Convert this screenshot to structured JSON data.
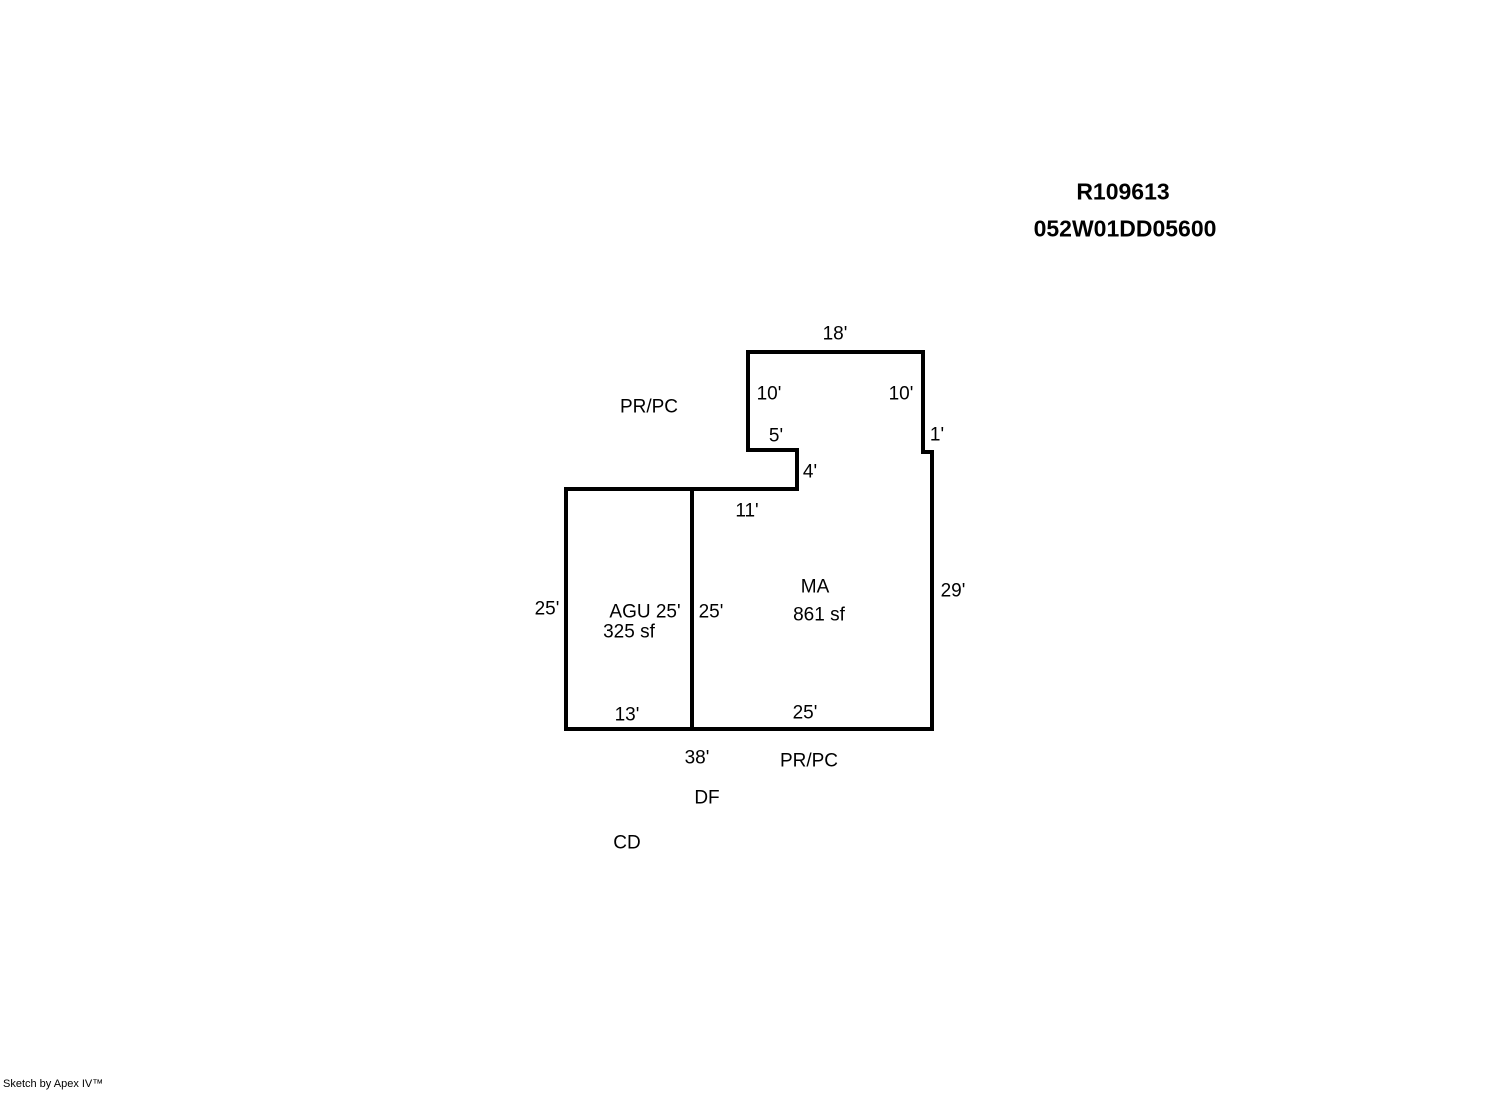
{
  "header": {
    "record_id": "R109613",
    "parcel_id": "052W01DD05600"
  },
  "sketch": {
    "stroke_color": "#000000",
    "background_color": "#ffffff",
    "stroke_width": 4,
    "outline_points": "748,352 923,352 923,452 932,452 932,729 566,729 566,489 797,489 797,450 748,450",
    "divider": {
      "x1": 692,
      "y1": 489,
      "x2": 692,
      "y2": 729
    },
    "labels": [
      {
        "name": "dim-top-18ft",
        "text": "18'",
        "x": 835,
        "y": 334
      },
      {
        "name": "label-pr-pc-upper",
        "text": "PR/PC",
        "x": 649,
        "y": 407
      },
      {
        "name": "dim-left-10ft",
        "text": "10'",
        "x": 769,
        "y": 394
      },
      {
        "name": "dim-right-10ft",
        "text": "10'",
        "x": 901,
        "y": 394
      },
      {
        "name": "dim-notch-5ft",
        "text": "5'",
        "x": 776,
        "y": 436
      },
      {
        "name": "dim-jog-1ft",
        "text": "1'",
        "x": 937,
        "y": 435
      },
      {
        "name": "dim-notch-4ft",
        "text": "4'",
        "x": 810,
        "y": 472
      },
      {
        "name": "dim-11ft",
        "text": "11'",
        "x": 747,
        "y": 511
      },
      {
        "name": "dim-left-25ft",
        "text": "25'",
        "x": 547,
        "y": 609
      },
      {
        "name": "label-agu-25ft",
        "text": "AGU 25'",
        "x": 645,
        "y": 612
      },
      {
        "name": "label-agu-area",
        "text": "325 sf",
        "x": 629,
        "y": 632
      },
      {
        "name": "dim-divider-25ft",
        "text": "25'",
        "x": 711,
        "y": 612
      },
      {
        "name": "label-ma",
        "text": "MA",
        "x": 815,
        "y": 587
      },
      {
        "name": "label-ma-area",
        "text": "861 sf",
        "x": 819,
        "y": 615
      },
      {
        "name": "dim-right-29ft",
        "text": "29'",
        "x": 953,
        "y": 591
      },
      {
        "name": "dim-bottom-13ft",
        "text": "13'",
        "x": 627,
        "y": 715
      },
      {
        "name": "dim-bottom-25ft",
        "text": "25'",
        "x": 805,
        "y": 713
      },
      {
        "name": "dim-bottom-38ft",
        "text": "38'",
        "x": 697,
        "y": 758
      },
      {
        "name": "label-pr-pc-lower",
        "text": "PR/PC",
        "x": 809,
        "y": 761
      },
      {
        "name": "label-df",
        "text": "DF",
        "x": 707,
        "y": 798
      },
      {
        "name": "label-cd",
        "text": "CD",
        "x": 627,
        "y": 843
      }
    ]
  },
  "footer": {
    "watermark": "Sketch by Apex IV™"
  }
}
